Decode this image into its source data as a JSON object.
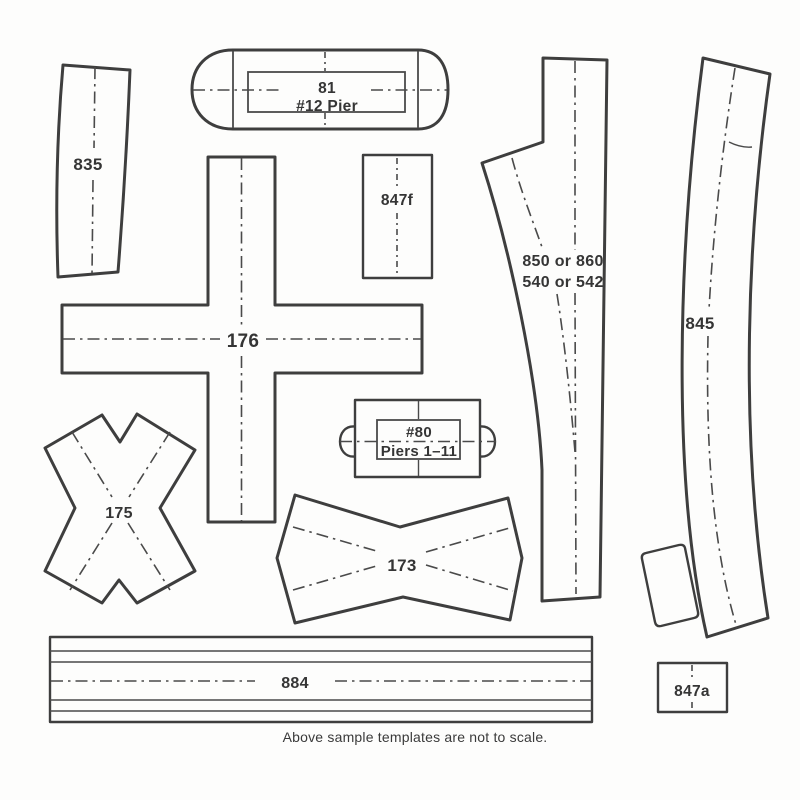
{
  "page": {
    "caption": "Above sample templates are not to scale.",
    "colors": {
      "ink": "#3e3e3e",
      "paper": "#fdfdfc"
    }
  },
  "templates": {
    "pier81": {
      "line1": "81",
      "line2": "#12 Pier"
    },
    "t835": {
      "label": "835"
    },
    "t847f": {
      "label": "847f"
    },
    "turnout": {
      "line1": "850 or 860",
      "line2": "540 or 542"
    },
    "t845": {
      "label": "845"
    },
    "t176": {
      "label": "176"
    },
    "pier80": {
      "line1": "#80",
      "line2": "Piers 1–11"
    },
    "t175": {
      "label": "175"
    },
    "t173": {
      "label": "173"
    },
    "t884": {
      "label": "884"
    },
    "t847a": {
      "label": "847a"
    }
  }
}
